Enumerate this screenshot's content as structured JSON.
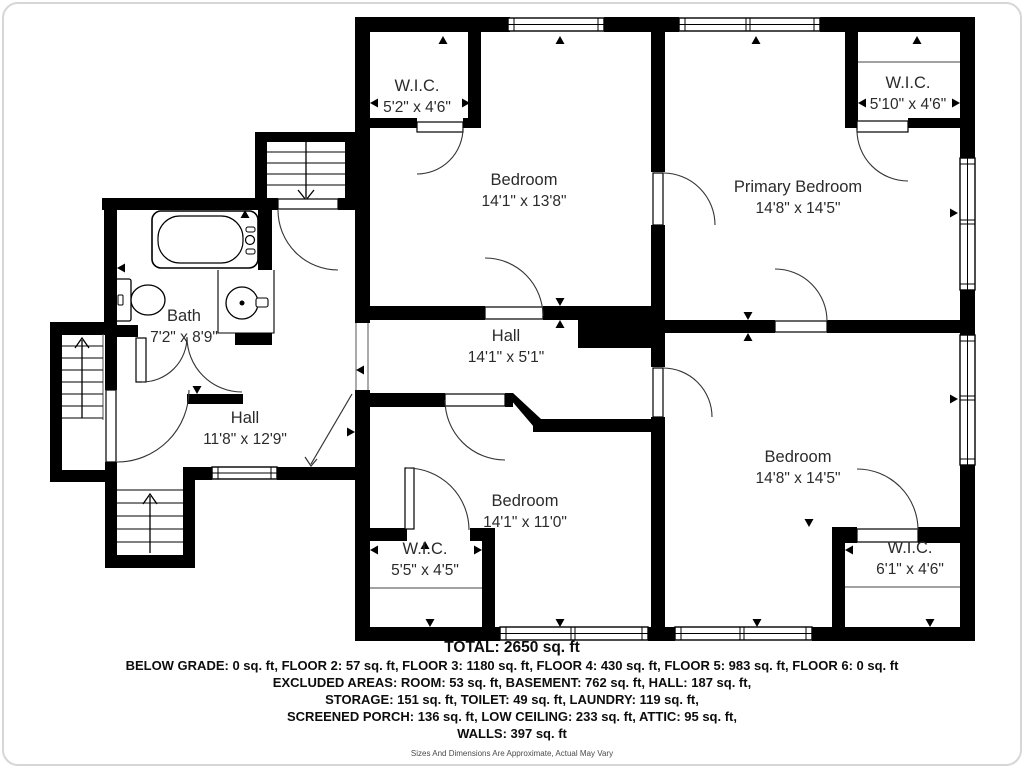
{
  "plan": {
    "rooms": {
      "bath": {
        "name": "Bath",
        "dims": "7'2\" x 8'9\""
      },
      "hall_left": {
        "name": "Hall",
        "dims": "11'8\" x 12'9\""
      },
      "hall_center": {
        "name": "Hall",
        "dims": "14'1\" x 5'1\""
      },
      "bedroom_top": {
        "name": "Bedroom",
        "dims": "14'1\" x 13'8\""
      },
      "primary_bedroom": {
        "name": "Primary Bedroom",
        "dims": "14'8\" x 14'5\""
      },
      "bedroom_bottom": {
        "name": "Bedroom",
        "dims": "14'1\" x 11'0\""
      },
      "bedroom_right": {
        "name": "Bedroom",
        "dims": "14'8\" x 14'5\""
      },
      "wic_top_left": {
        "name": "W.I.C.",
        "dims": "5'2\" x 4'6\""
      },
      "wic_top_right": {
        "name": "W.I.C.",
        "dims": "5'10\" x 4'6\""
      },
      "wic_bottom_left": {
        "name": "W.I.C.",
        "dims": "5'5\" x 4'5\""
      },
      "wic_bottom_right": {
        "name": "W.I.C.",
        "dims": "6'1\" x 4'6\""
      }
    },
    "wall_color": "#000000",
    "background_color": "#ffffff"
  },
  "footer": {
    "total": "TOTAL: 2650 sq. ft",
    "lines": [
      "BELOW GRADE: 0 sq. ft, FLOOR 2: 57 sq. ft, FLOOR 3: 1180 sq. ft, FLOOR 4: 430 sq. ft, FLOOR 5: 983 sq. ft, FLOOR 6: 0 sq. ft",
      "EXCLUDED AREAS: ROOM: 53 sq. ft, BASEMENT: 762 sq. ft, HALL: 187 sq. ft,",
      "STORAGE: 151 sq. ft, TOILET: 49 sq. ft, LAUNDRY: 119 sq. ft,",
      "SCREENED PORCH: 136 sq. ft, LOW CEILING: 233 sq. ft, ATTIC: 95 sq. ft,",
      "WALLS: 397 sq. ft"
    ],
    "disclaimer": "Sizes And Dimensions Are Approximate, Actual May Vary"
  }
}
